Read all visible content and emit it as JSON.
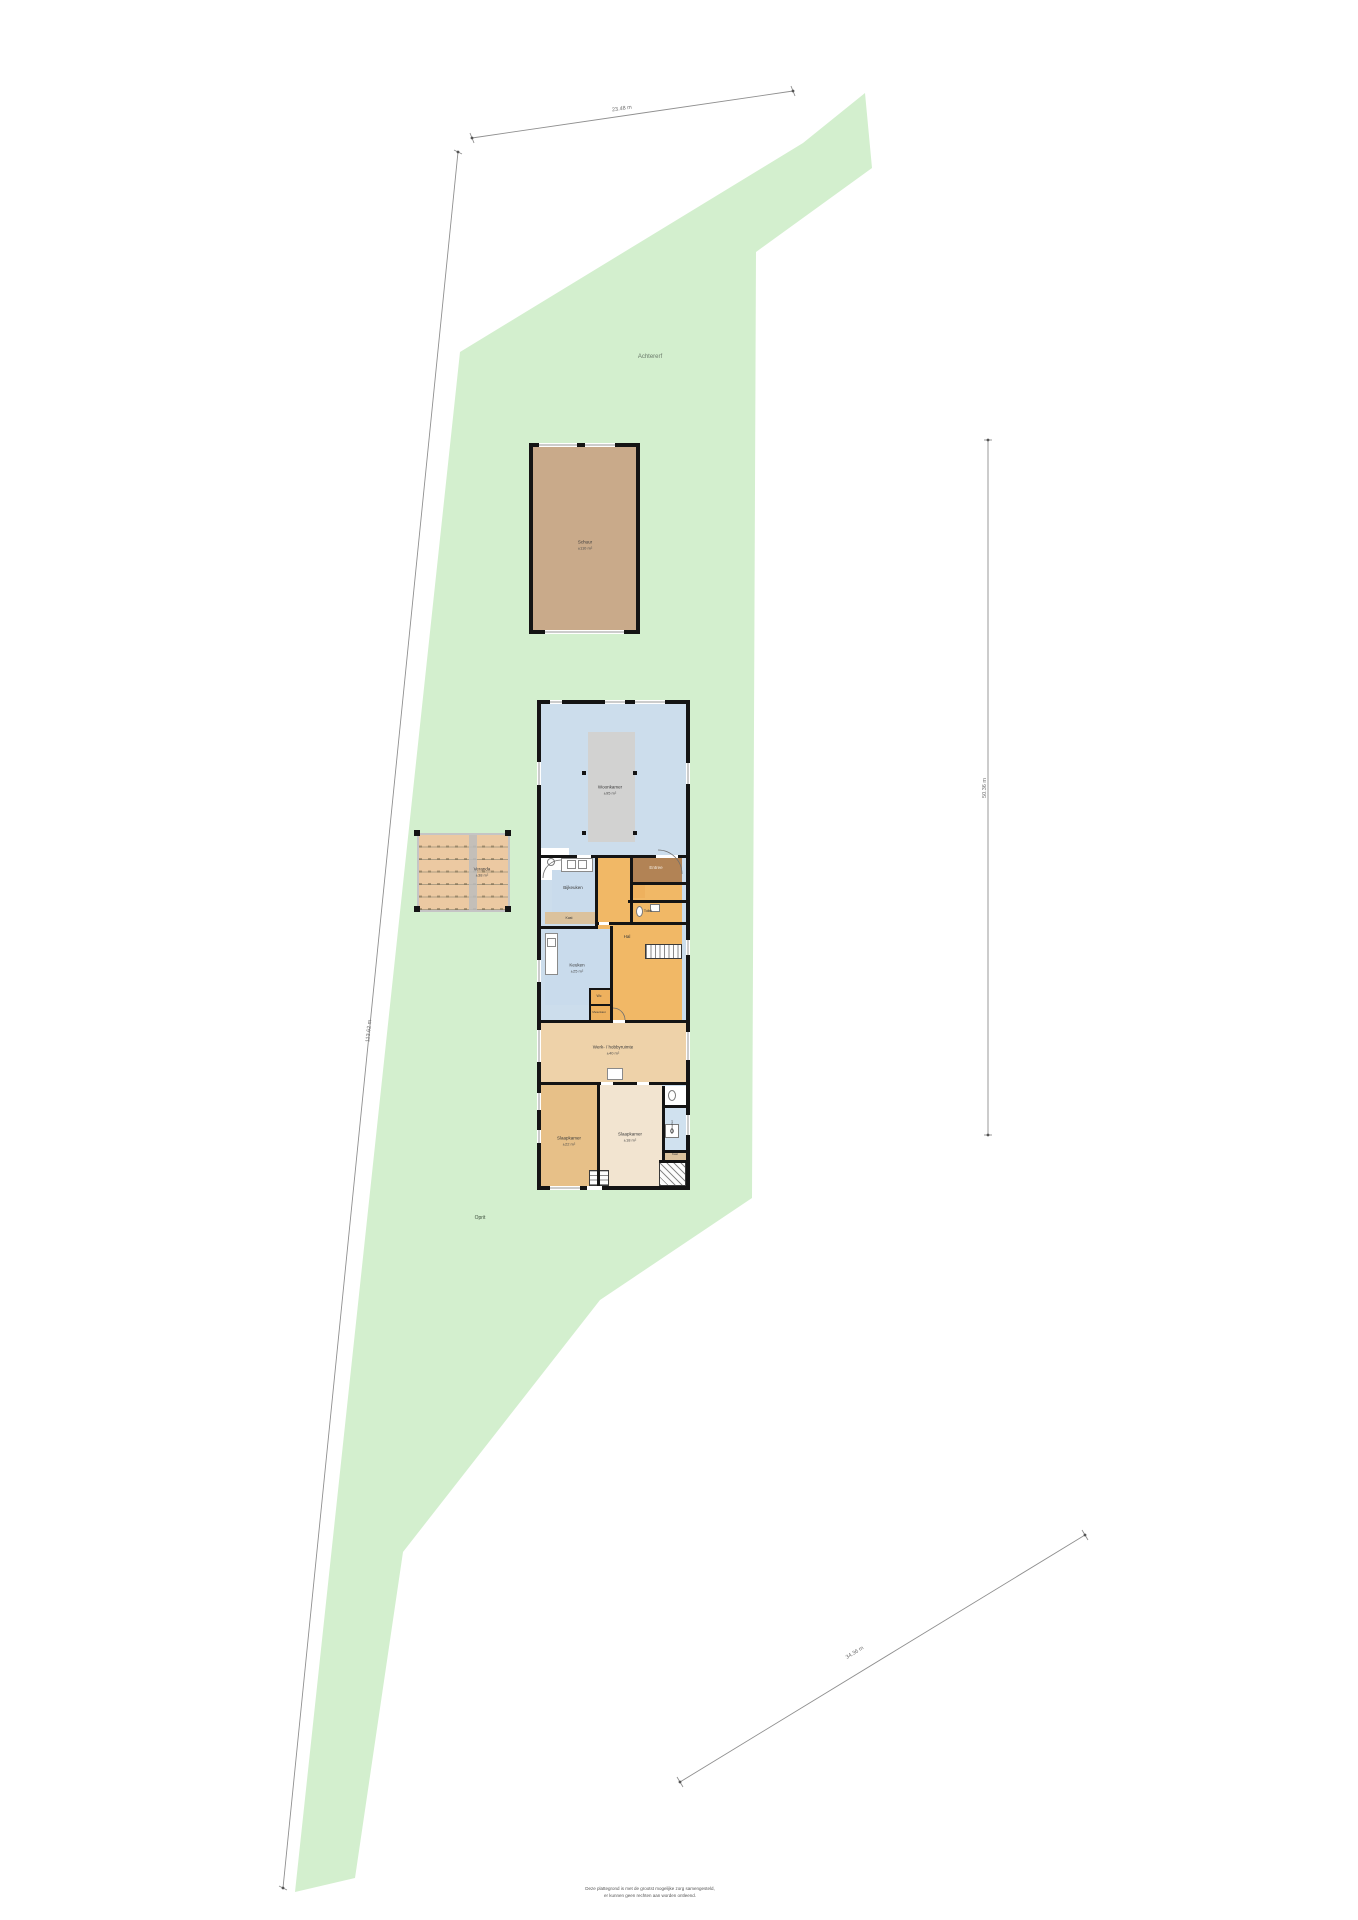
{
  "site": {
    "labels": {
      "back_yard": "Achtererf",
      "driveway": "Oprit"
    },
    "dimensions": {
      "top": "23.48 m",
      "right": "50.36 m",
      "left": "113.62 m",
      "bottom_right": "34.36 m"
    },
    "colors": {
      "parcel_green": "#d3efce",
      "barn_fill": "#c9aa8a",
      "deck_fill": "#ecc9a2",
      "room_blue": "#ccddec",
      "hall_orange": "#f1b866",
      "room_tan": "#eed2a9",
      "wall_black": "#141414"
    }
  },
  "barn": {
    "name": "Schuur",
    "area": "±110 m²"
  },
  "veranda": {
    "name": "Veranda",
    "area": "±38 m²"
  },
  "house": {
    "rooms": {
      "woonkamer": {
        "name": "Woonkamer",
        "area": "±95 m²"
      },
      "bijkeuken": {
        "name": "Bijkeuken"
      },
      "kast1": {
        "name": "Kast"
      },
      "entree": {
        "name": "Entree"
      },
      "toilet": {
        "name": "Toilet"
      },
      "hal": {
        "name": "Hal"
      },
      "keuken": {
        "name": "Keuken",
        "area": "±25 m²"
      },
      "wc": {
        "name": "Wc"
      },
      "meterkast": {
        "name": "Meterkast"
      },
      "werkruimte": {
        "name": "Werk- / hobbyruimte",
        "area": "±40 m²"
      },
      "slaapkamer1": {
        "name": "Slaapkamer",
        "area": "±22 m²"
      },
      "slaapkamer2": {
        "name": "Slaapkamer",
        "area": "±18 m²"
      },
      "badkamer": {
        "name": "Badkamer"
      },
      "kast2": {
        "name": "Kast"
      }
    }
  },
  "footer": {
    "line1": "Deze plattegrond is met de grootst mogelijke zorg samengesteld,",
    "line2": "er kunnen geen rechten aan worden ontleend."
  }
}
